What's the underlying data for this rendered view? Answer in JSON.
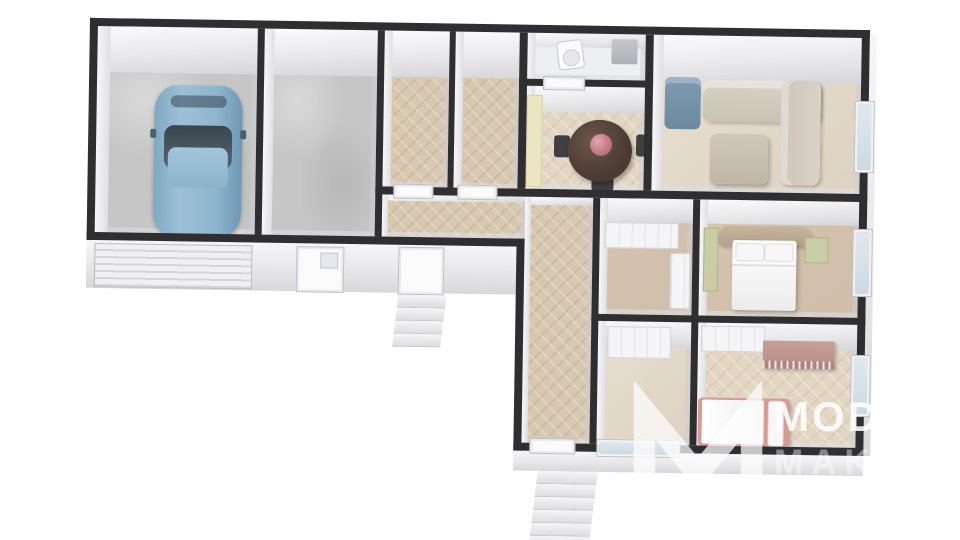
{
  "watermark": {
    "brand_line1": "MODER",
    "brand_line2": "MAKLÉ",
    "logo": "m-monogram-icon"
  },
  "scene": {
    "type": "3d-floor-plan-render",
    "rooms": [
      {
        "id": "garage",
        "floor": "concrete",
        "furniture": [
          "blue-car",
          "garage-door"
        ]
      },
      {
        "id": "garage-storage",
        "floor": "concrete",
        "furniture": [
          "entry-door"
        ]
      },
      {
        "id": "small-room-1",
        "floor": "herringbone-parquet",
        "furniture": []
      },
      {
        "id": "small-room-2",
        "floor": "herringbone-parquet",
        "furniture": []
      },
      {
        "id": "wc",
        "floor": "tile",
        "furniture": [
          "toilet",
          "grey-cabinet"
        ]
      },
      {
        "id": "dining-kitchen",
        "floor": "herringbone-parquet",
        "furniture": [
          "round-table",
          "chairs",
          "flower-bouquet",
          "cream-counter"
        ]
      },
      {
        "id": "living-room",
        "floor": "parquet",
        "furniture": [
          "corner-sofa",
          "blue-armchair",
          "ottoman",
          "plant"
        ]
      },
      {
        "id": "hallway-horizontal",
        "floor": "herringbone-parquet",
        "furniture": [
          "side-exterior-steps"
        ]
      },
      {
        "id": "hallway-vertical",
        "floor": "herringbone-parquet",
        "furniture": [
          "entrance-steps"
        ]
      },
      {
        "id": "closet-hall",
        "floor": "parquet",
        "furniture": [
          "white-wardrobe"
        ]
      },
      {
        "id": "bedroom-1",
        "floor": "parquet",
        "furniture": [
          "double-bed",
          "tan-headboard",
          "green-nightstand",
          "green-wardrobe",
          "window"
        ]
      },
      {
        "id": "wardrobe-room",
        "floor": "parquet",
        "furniture": [
          "white-wardrobe"
        ]
      },
      {
        "id": "bedroom-2",
        "floor": "herringbone-parquet",
        "furniture": [
          "pink-bed",
          "white-wardrobe",
          "mauve-cabinet",
          "plant",
          "window"
        ]
      }
    ]
  },
  "colors": {
    "wall": "#2f2f32",
    "concrete": "#c6c6c6",
    "herr": "#d8c8b0",
    "herr-light": "#e3d7c3",
    "tan": "#d5c5b0",
    "wood-light": "#e8e0d2",
    "tile": "#edeff1",
    "car-body": "#8fb6cf",
    "car-glass": "#39464f",
    "sofa": "#d9d3c7",
    "pillow": "#5d604b",
    "armchair": "#7e9bb1",
    "ottoman": "#cfc7b8",
    "plant": "#4d7743",
    "table": "#4a3a32",
    "flower": "#c27683",
    "counter": "#ece5c1",
    "headboard": "#c7b49c",
    "green-cab": "#c9cda3",
    "bed2": "#d89a92",
    "mauve": "#c79e98",
    "step": "#eeeef1",
    "glass": "#dfe8ee",
    "watermark": "#ffffff"
  }
}
